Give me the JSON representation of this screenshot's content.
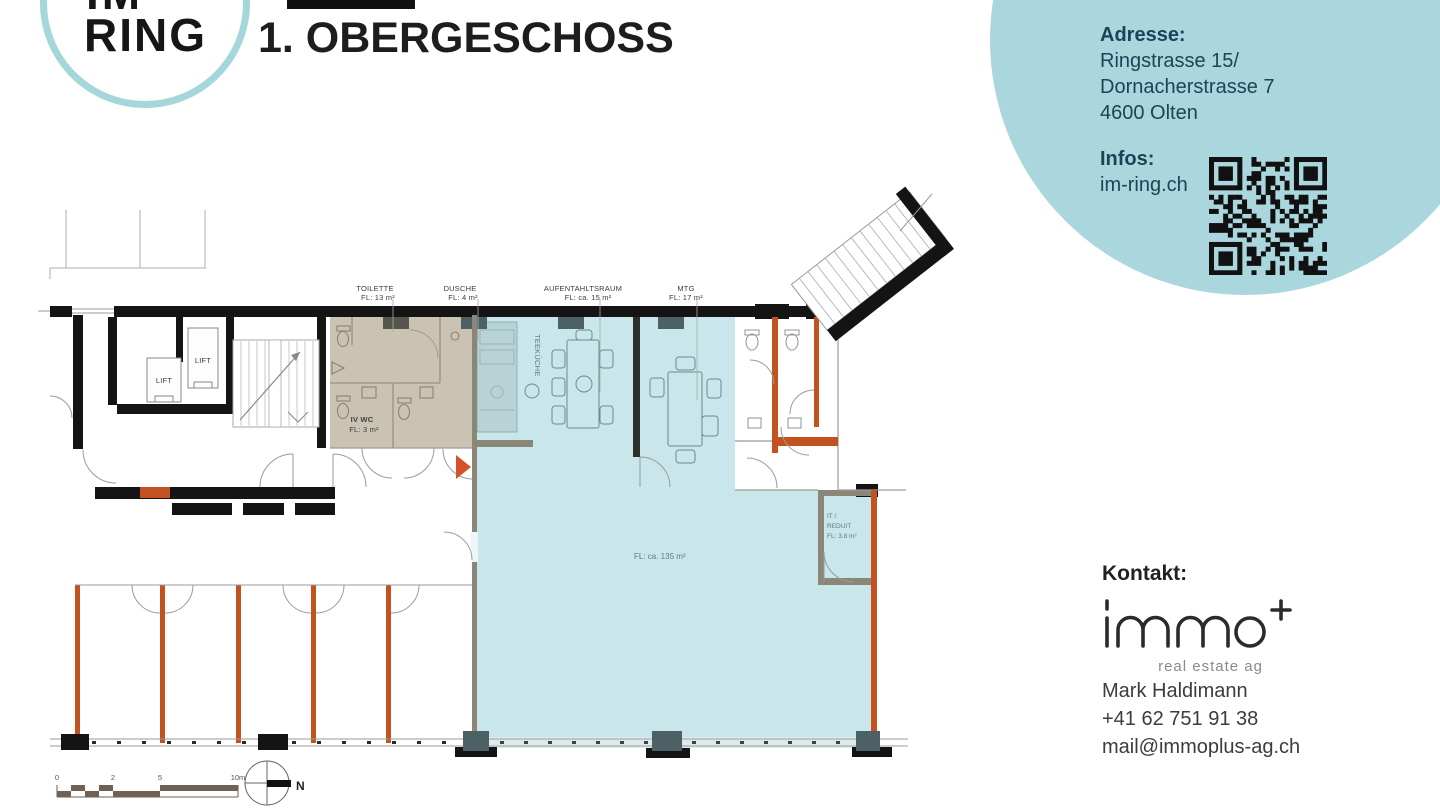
{
  "header": {
    "logo_line1": "IM",
    "logo_line2": "RING",
    "title": "1. OBERGESCHOSS"
  },
  "info_bubble": {
    "address_heading": "Adresse:",
    "address_lines": [
      "Ringstrasse  15/",
      "Dornacherstrasse  7",
      "4600 Olten"
    ],
    "infos_heading": "Infos:",
    "infos_link": "im-ring.ch"
  },
  "contact": {
    "heading": "Kontakt:",
    "logo_subtitle": "real estate ag",
    "name": "Mark Haldimann",
    "phone": "+41 62 751 91 38",
    "email": "mail@immoplus-ag.ch"
  },
  "floor_plan": {
    "labels": {
      "toilette": {
        "name": "TOILETTE",
        "area": "FL: 13 m²"
      },
      "dusche": {
        "name": "DUSCHE",
        "area": "FL: 4 m²"
      },
      "aufenthaltsraum": {
        "name": "AUFENTAHLTSRAUM",
        "area": "FL: ca. 15 m²"
      },
      "mtg": {
        "name": "MTG",
        "area": "FL: 17 m²"
      },
      "iv_wc": {
        "name": "IV WC",
        "area": "FL: 3 m²"
      },
      "teekueche": {
        "name": "TEEKÜCHE"
      },
      "hauptraum": {
        "area": "FL:  ca. 135 m²"
      },
      "it_reduit": {
        "line1": "IT /",
        "line2": "REDUIT",
        "area": "FL: 3.8 m²"
      },
      "lift_left": {
        "name": "LIFT"
      },
      "lift_right": {
        "name": "LIFT"
      }
    },
    "scale_bar": {
      "tick0": "0",
      "tick2": "2",
      "tick5": "5",
      "tick10": "10m"
    },
    "north_label": "N",
    "colors": {
      "highlight_teal": "#c9e6ea",
      "beige": "#cbc3b2",
      "wall_orange": "#c2521f",
      "bubble_teal": "#a9d7dd"
    }
  }
}
